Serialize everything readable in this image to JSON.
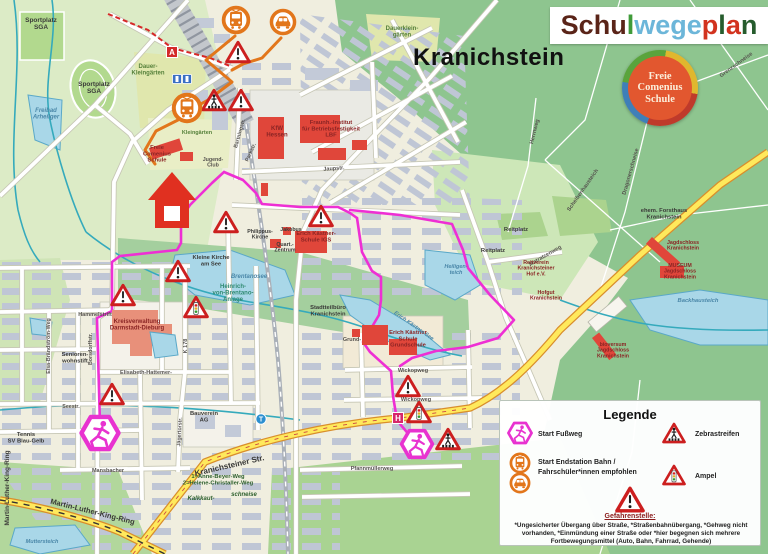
{
  "area_title": "Kranichstein",
  "logo": {
    "text": "Schulwegeplan",
    "letters": [
      [
        "S",
        "#5a2418"
      ],
      [
        "c",
        "#5a2418"
      ],
      [
        "h",
        "#5a2418"
      ],
      [
        "u",
        "#5a2418"
      ],
      [
        "l",
        "#3f9b3a"
      ],
      [
        "w",
        "#6cb6d9"
      ],
      [
        "e",
        "#6cb6d9"
      ],
      [
        "g",
        "#6cb6d9"
      ],
      [
        "e",
        "#6cb6d9"
      ],
      [
        "p",
        "#d2331f"
      ],
      [
        "l",
        "#265c2d"
      ],
      [
        "a",
        "#d2331f"
      ],
      [
        "n",
        "#265c2d"
      ]
    ]
  },
  "badge": {
    "lines": [
      "Freie",
      "Comenius",
      "Schule"
    ]
  },
  "legend": {
    "title": "Legende",
    "items": [
      {
        "icon": "hexagon-runner",
        "label": "Start Fußweg"
      },
      {
        "icon": "circles-tram-car",
        "label": "Start Endstation Bahn /\nFahrschüler*innen empfohlen"
      },
      {
        "icon": "triangle-zebra",
        "label": "Zebrastreifen"
      },
      {
        "icon": "triangle-ampel",
        "label": "Ampel"
      }
    ],
    "hazard": {
      "heading": "Gefahrenstelle:",
      "text": "*Ungesicherter Übergang über Straße, *Straßenbahnübergang, *Gehweg nicht vorhanden, *Einmündung einer Straße oder *hier begegnen sich mehrere Fortbewegungsmittel (Auto, Bahn, Fahrrad, Gehende)"
    }
  },
  "map": {
    "colors": {
      "route_walk_magenta": "#ee2fd4",
      "route_transit_orange": "#e2761b",
      "hazard_triangle_red": "#cc1f1f",
      "main_road_yellow": "#ffe95c",
      "water": "#a9d7e8",
      "forest_green": "#8ec58f",
      "poi_red_building": "#e0463a"
    },
    "labels": [
      {
        "t": "Sportplatz\nSGA",
        "x": 41,
        "y": 22,
        "s": 6.5
      },
      {
        "t": "Sportplatz\nSGA",
        "x": 94,
        "y": 86,
        "s": 6.5
      },
      {
        "t": "Freibad\nArheilger",
        "x": 46,
        "y": 112,
        "s": 6,
        "c": "#4a87a8",
        "i": 1
      },
      {
        "t": "Dauer-\nKleingärten",
        "x": 148,
        "y": 68,
        "s": 6,
        "c": "#55803a"
      },
      {
        "t": "Dauerklein-\ngärten",
        "x": 402,
        "y": 30,
        "s": 6,
        "c": "#55803a"
      },
      {
        "t": "Kleingärten",
        "x": 197,
        "y": 134,
        "s": 5.5,
        "c": "#55803a"
      },
      {
        "t": "KfW\nHessen",
        "x": 277,
        "y": 130,
        "s": 6,
        "c": "#8a2424"
      },
      {
        "t": "Fraunh.-Institut\nfür Betriebsfestigkeit\nLBF",
        "x": 331,
        "y": 124,
        "s": 5.8,
        "c": "#8a2424"
      },
      {
        "t": "Jaupstr.",
        "x": 334,
        "y": 170,
        "s": 5.5,
        "c": "#55524e",
        "r": -4
      },
      {
        "t": "Freie\nComenius\nSchule",
        "x": 157,
        "y": 149,
        "s": 5.8,
        "c": "#8a2424"
      },
      {
        "t": "Jugend-\nClub",
        "x": 213,
        "y": 161,
        "s": 5.3,
        "c": "#55524e"
      },
      {
        "t": "Kleine Kirche\nam See",
        "x": 211,
        "y": 259,
        "s": 5.8
      },
      {
        "t": "Brentanosee",
        "x": 249,
        "y": 278,
        "s": 6,
        "c": "#4a87a8",
        "i": 1
      },
      {
        "t": "Heinrich-\nvon-Brentano-\nAnlage",
        "x": 233,
        "y": 288,
        "s": 6,
        "c": "#2f8a70"
      },
      {
        "t": "Philippus-\nKirche",
        "x": 260,
        "y": 233,
        "s": 5.3
      },
      {
        "t": "Quart.-\nZentrum",
        "x": 285,
        "y": 246,
        "s": 5.3
      },
      {
        "t": "Jakobus",
        "x": 291,
        "y": 231,
        "s": 5.3
      },
      {
        "t": "Erich Kästner-\nSchule IGS",
        "x": 316,
        "y": 235,
        "s": 5.8,
        "c": "#8a2424"
      },
      {
        "t": "Stadtteilbüro\nKranichstein",
        "x": 328,
        "y": 309,
        "s": 5.8
      },
      {
        "t": "Erich Kästner\nSchule\nGrundschule",
        "x": 408,
        "y": 334,
        "s": 5.8,
        "c": "#8a2424"
      },
      {
        "t": "Erich Kästner See",
        "x": 413,
        "y": 327,
        "s": 5.5,
        "c": "#4a87a8",
        "i": 1,
        "r": 35
      },
      {
        "t": "Wickopweg",
        "x": 413,
        "y": 372,
        "s": 5.5,
        "c": "#55524e"
      },
      {
        "t": "Wickopweg",
        "x": 416,
        "y": 401,
        "s": 5.5,
        "c": "#55524e"
      },
      {
        "t": "Grund-",
        "x": 352,
        "y": 341,
        "s": 5.5,
        "c": "#55524e"
      },
      {
        "t": "Pfannmüllerweg",
        "x": 372,
        "y": 470,
        "s": 5.5,
        "c": "#55524e"
      },
      {
        "t": "Kranichsteiner Str.",
        "x": 230,
        "y": 468,
        "s": 8,
        "r": -13,
        "w": 700
      },
      {
        "t": "Martin-Luther-King-Ring",
        "x": 92,
        "y": 514,
        "s": 7.5,
        "r": 14,
        "w": 700
      },
      {
        "t": "Martin-Luther-King-Ring",
        "x": 9,
        "y": 488,
        "s": 6.5,
        "r": -90,
        "w": 700
      },
      {
        "t": "Mansbacher",
        "x": 108,
        "y": 472,
        "s": 5.5,
        "c": "#55524e"
      },
      {
        "t": "Tennis\nSV Blau-Gelb",
        "x": 26,
        "y": 436,
        "s": 5.8
      },
      {
        "t": "Muttersteich",
        "x": 42,
        "y": 543,
        "s": 5.5,
        "c": "#4a87a8",
        "i": 1
      },
      {
        "t": "Senioren-\nwohnstift",
        "x": 75,
        "y": 356,
        "s": 5.8
      },
      {
        "t": "Kreisverwaltung\nDarmstadt-Dieburg",
        "x": 137,
        "y": 323,
        "s": 6,
        "c": "#8a2424"
      },
      {
        "t": "Elisabeth-Hattemer-",
        "x": 146,
        "y": 374,
        "s": 5.5,
        "c": "#55524e"
      },
      {
        "t": "Bauverein\nAG",
        "x": 204,
        "y": 415,
        "s": 5.8
      },
      {
        "t": "Jägertorstr.",
        "x": 181,
        "y": 432,
        "s": 5.3,
        "c": "#55524e",
        "r": -87
      },
      {
        "t": "1=Anne-Beyer-Weg\n2=Helene-Christaller-Weg",
        "x": 218,
        "y": 478,
        "s": 5.8,
        "c": "#2c5f2c"
      },
      {
        "t": "Kalkkaut-",
        "x": 201,
        "y": 500,
        "s": 6,
        "c": "#2c5f2c",
        "i": 1
      },
      {
        "t": "schneise",
        "x": 244,
        "y": 496,
        "s": 6,
        "c": "#2c5f2c",
        "i": 1
      },
      {
        "t": "Seestr.",
        "x": 71,
        "y": 408,
        "s": 5.3,
        "c": "#55524e"
      },
      {
        "t": "Hammelstrift",
        "x": 95,
        "y": 316,
        "s": 5.5,
        "c": "#55524e"
      },
      {
        "t": "Elsa-Brändström-Weg",
        "x": 50,
        "y": 346,
        "s": 5.3,
        "c": "#55524e",
        "r": -90
      },
      {
        "t": "Borsdorffstr.",
        "x": 92,
        "y": 349,
        "s": 5.3,
        "c": "#55524e",
        "r": -90
      },
      {
        "t": "Bartningstr.",
        "x": 241,
        "y": 134,
        "s": 5.3,
        "c": "#55524e",
        "r": -74
      },
      {
        "t": "Parkstr.",
        "x": 252,
        "y": 153,
        "s": 5.3,
        "c": "#55524e",
        "r": -66
      },
      {
        "t": "K 178",
        "x": 187,
        "y": 346,
        "s": 5.5,
        "c": "#55524e",
        "r": -90
      },
      {
        "t": "Reitplatz",
        "x": 516,
        "y": 231,
        "s": 5.8
      },
      {
        "t": "Reitplatz",
        "x": 493,
        "y": 252,
        "s": 5.8
      },
      {
        "t": "Matratzenweg",
        "x": 546,
        "y": 257,
        "s": 5.5,
        "c": "#55524e",
        "r": -30
      },
      {
        "t": "Heiligen-\nteich",
        "x": 456,
        "y": 268,
        "s": 5.5,
        "c": "#4a87a8",
        "i": 1
      },
      {
        "t": "Reitverein\nKranichsteiner\nHof e.V.",
        "x": 536,
        "y": 264,
        "s": 5.3,
        "c": "#8a2424"
      },
      {
        "t": "Hofgut\nKranichstein",
        "x": 546,
        "y": 294,
        "s": 5.3,
        "c": "#8a2424"
      },
      {
        "t": "ehem. Forsthaus\nKranichstein",
        "x": 664,
        "y": 212,
        "s": 5.8
      },
      {
        "t": "Jagdschloss\nKranichstein",
        "x": 683,
        "y": 244,
        "s": 5.3,
        "c": "#8a2424"
      },
      {
        "t": "MUSEUM\nJagdschloss\nKranichstein",
        "x": 680,
        "y": 267,
        "s": 5.3,
        "c": "#8a2424"
      },
      {
        "t": "Backhausteich",
        "x": 698,
        "y": 302,
        "s": 5.8,
        "c": "#4a87a8",
        "i": 1
      },
      {
        "t": "bioversum\nJagdschloss\nKranichstein",
        "x": 613,
        "y": 346,
        "s": 5.3,
        "c": "#8a2424"
      },
      {
        "t": "Grenzschneise",
        "x": 737,
        "y": 66,
        "s": 5.5,
        "c": "#55524e",
        "r": -36
      },
      {
        "t": "Herrnweg",
        "x": 536,
        "y": 132,
        "s": 5.5,
        "c": "#55524e",
        "r": -76
      },
      {
        "t": "Dragonerschneise",
        "x": 632,
        "y": 172,
        "s": 5.5,
        "c": "#55524e",
        "r": -74
      },
      {
        "t": "Scheibenhausteich",
        "x": 584,
        "y": 191,
        "s": 5.5,
        "c": "#55524e",
        "r": -55
      }
    ],
    "markers": {
      "triangles": [
        [
          238,
          52,
          "excl"
        ],
        [
          214,
          100,
          "zebra"
        ],
        [
          241,
          100,
          "excl"
        ],
        [
          226,
          222,
          "excl"
        ],
        [
          321,
          216,
          "excl"
        ],
        [
          123,
          295,
          "excl"
        ],
        [
          178,
          271,
          "excl"
        ],
        [
          196,
          307,
          "ampel"
        ],
        [
          112,
          394,
          "excl"
        ],
        [
          408,
          386,
          "excl"
        ],
        [
          419,
          412,
          "ampel"
        ],
        [
          448,
          439,
          "zebra"
        ]
      ],
      "circles": [
        [
          236,
          20,
          15,
          "tram"
        ],
        [
          283,
          22,
          14,
          "car"
        ],
        [
          187,
          108,
          16,
          "tram"
        ]
      ],
      "hexagons": [
        [
          100,
          433,
          24
        ],
        [
          417,
          444,
          20
        ]
      ],
      "letter_boxes": [
        [
          172,
          52,
          "A",
          "#d42a2a"
        ],
        [
          398,
          418,
          "H",
          "#d6276b"
        ]
      ],
      "tram_stop": [
        261,
        419,
        "T",
        "#2b8fd0"
      ],
      "line_badges": [
        [
          177,
          79
        ],
        [
          187,
          79
        ]
      ]
    }
  }
}
